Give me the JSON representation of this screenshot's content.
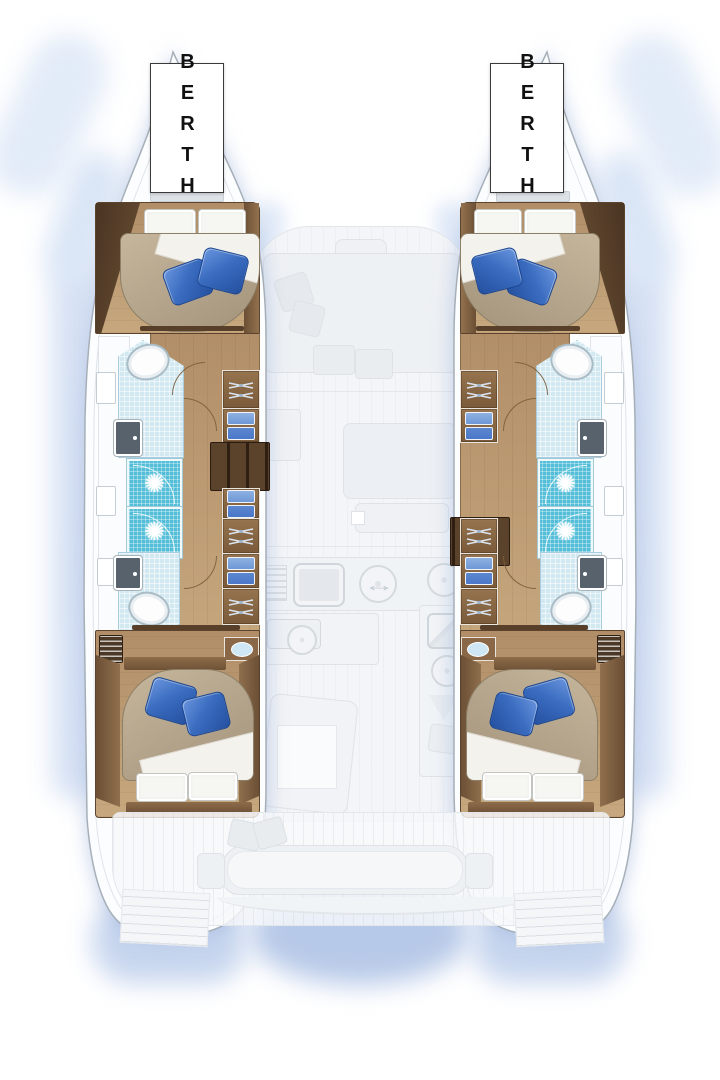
{
  "labels": {
    "port_berth": "BERTH",
    "starboard_berth": "BERTH"
  },
  "icons": {
    "shower_drain": "✺",
    "galley_arrow": "↔"
  },
  "colors": {
    "wood_floor": "#b18e68",
    "wood_floor_light": "#c7a87e",
    "wood_wall": "#4a3523",
    "wood_trim": "#6b4f35",
    "wood_cabinet": "#8a6847",
    "steps_dark": "#3a2a1b",
    "shower_teal": "#54bed8",
    "tile_blue": "#d2e9f2",
    "pillow_blue": "#3a6cc0",
    "pillow_blue_dark": "#25509f",
    "duvet_tan": "#c6b69c",
    "duvet_tan_dark": "#a2937b",
    "bedding_white": "#f6f6f2",
    "fixture_dark": "#57626c",
    "clothes_blue": "#4a78c8",
    "clothes_blue_light": "#8fb1e2",
    "hanger_gray": "#dbe4ee",
    "ghost_fill": "#eff1f4",
    "ghost_line": "#dfe3e8",
    "glow_blue": "#cfdcf2",
    "glow_deep": "#b7c9e8",
    "hull_line": "#a6afb8",
    "hull_fill": "#fcfdfe",
    "berth_border": "#3a3a3a",
    "berth_text": "#111111"
  }
}
